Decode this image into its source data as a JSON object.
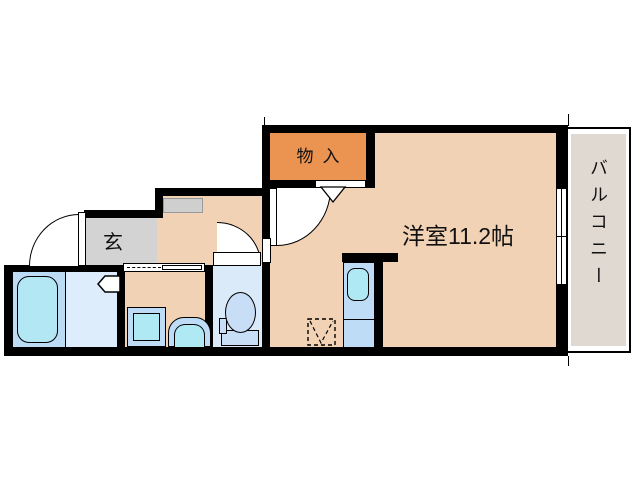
{
  "plan": {
    "title": "apartment-floor-plan",
    "rooms": {
      "storage": {
        "label": "物入"
      },
      "main": {
        "label": "洋室11.2帖"
      },
      "balcony": {
        "label": "バルコニー"
      },
      "entrance": {
        "label": "玄"
      }
    },
    "fixtures": [
      "bathtub",
      "bathroom-folding-door",
      "washing-machine",
      "wash-basin",
      "toilet",
      "kitchen-unit",
      "kitchen-sink",
      "washer-space",
      "shoe-cabinet",
      "sliding-window",
      "entrance-door",
      "room-door",
      "toilet-door",
      "closet-bifold-door"
    ],
    "colors": {
      "wall": "#000000",
      "room_fill": "#F2D2B4",
      "storage_fill": "#EB9351",
      "entrance_fill": "#D3D3D3",
      "balcony_fill": "#DFD9D1",
      "bath_zone": "#BCDBF4",
      "bath_floor": "#DEEDFB",
      "tub_fill": "#B2E7F3",
      "fixture_blue": "#BFDCF6",
      "fixture_cyan": "#AEE9F4",
      "toilet_floor": "#DBEAF8"
    }
  }
}
